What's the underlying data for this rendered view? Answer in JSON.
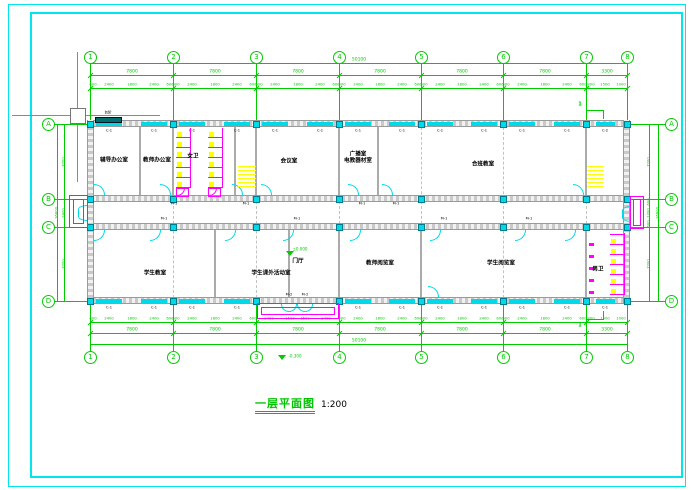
{
  "drawing": {
    "title": "一层平面图",
    "scale": "1:200",
    "section_label": "1"
  },
  "levels": {
    "floor": "±0.000",
    "hall": "门厅",
    "outdoor": "-0.300"
  },
  "annotations": {
    "steps": "台阶"
  },
  "colors": {
    "frame_cyan": "#00e5ee",
    "axis_green": "#00cc00",
    "wall_gray": "#c9c9c9",
    "window_cyan": "#00ffff",
    "sanitary_magenta": "#ff00ff",
    "stair_yellow": "#ffff00",
    "label_black": "#000000",
    "canopy_teal": "#006d6d"
  },
  "grid": {
    "cols": [
      {
        "label": "1",
        "x": 90
      },
      {
        "label": "2",
        "x": 173
      },
      {
        "label": "3",
        "x": 256
      },
      {
        "label": "4",
        "x": 339
      },
      {
        "label": "5",
        "x": 421
      },
      {
        "label": "6",
        "x": 503
      },
      {
        "label": "7",
        "x": 586
      },
      {
        "label": "8",
        "x": 627
      }
    ],
    "rows": [
      {
        "label": "A",
        "y": 124
      },
      {
        "label": "B",
        "y": 199
      },
      {
        "label": "C",
        "y": 227
      },
      {
        "label": "D",
        "y": 301
      }
    ]
  },
  "dims": {
    "total": "50100",
    "bays": [
      "7800",
      "7800",
      "7800",
      "7800",
      "7800",
      "7800",
      "3300"
    ],
    "bay_fine": [
      "600",
      "2400",
      "1800",
      "2400",
      "600"
    ],
    "last_bay_fine": [
      "800",
      "1500",
      "1000"
    ],
    "entry_bay_fine": [
      "2400",
      "1500",
      "1500",
      "2400"
    ],
    "side_total": "16800",
    "side_left": [
      "7200",
      "2400",
      "7200"
    ],
    "side_right": [
      "7200",
      "600",
      "1200",
      "600",
      "7200"
    ]
  },
  "rooms": [
    {
      "name": "辅导办公室",
      "x": 114,
      "y": 161
    },
    {
      "name": "教师办公室",
      "x": 157,
      "y": 161
    },
    {
      "name": "女卫",
      "x": 193,
      "y": 157
    },
    {
      "name": "会议室",
      "x": 289,
      "y": 162
    },
    {
      "name": "广播室\n电教器材室",
      "x": 358,
      "y": 158
    },
    {
      "name": "合班教室",
      "x": 483,
      "y": 165
    },
    {
      "name": "学生教室",
      "x": 155,
      "y": 274
    },
    {
      "name": "学生课外活动室",
      "x": 271,
      "y": 274
    },
    {
      "name": "教师阅览室",
      "x": 380,
      "y": 264
    },
    {
      "name": "学生阅览室",
      "x": 501,
      "y": 264
    },
    {
      "name": "男卫",
      "x": 598,
      "y": 270
    }
  ],
  "openings": {
    "window": "C-1",
    "window_end": "C-2",
    "door": "M-1",
    "entry_door": "M-2"
  },
  "doors": {
    "b_wall_up": [
      94,
      160,
      232,
      261,
      348,
      382,
      573
    ],
    "c_wall_down": [
      94,
      150,
      225,
      283,
      350,
      430,
      515,
      565
    ],
    "d_wall_up": [
      428
    ],
    "m1_b": [
      160,
      232,
      348,
      382
    ],
    "m1_c": [
      150,
      283,
      430,
      515
    ]
  }
}
